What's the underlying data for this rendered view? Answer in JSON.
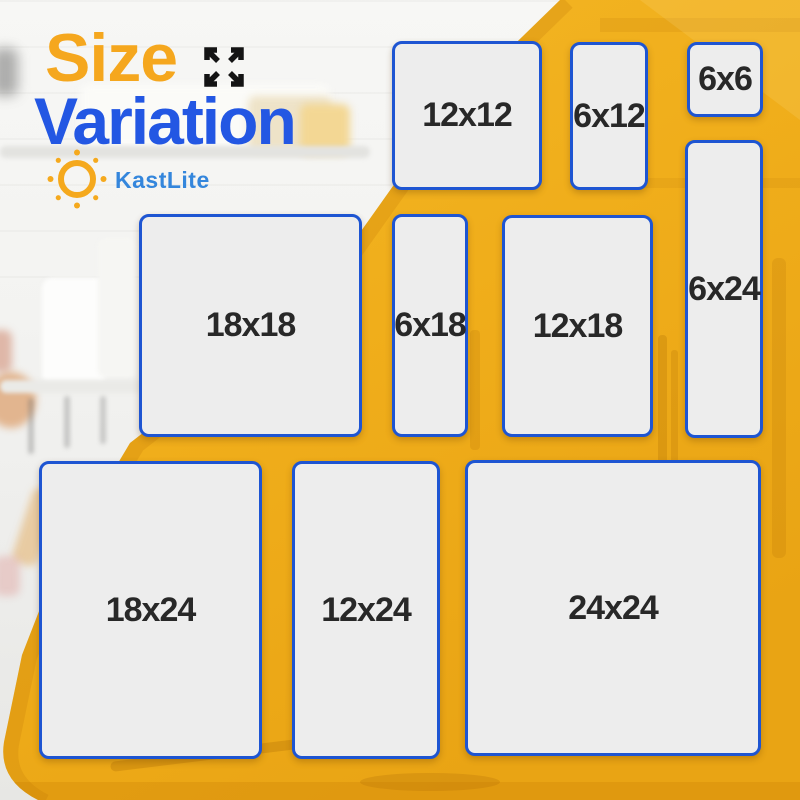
{
  "poster": {
    "title_line1": "Size",
    "title_line2": "Variation",
    "brand": "KastLite"
  },
  "icons": {
    "expand": "expand-arrows-icon",
    "sun": "sun-icon"
  },
  "colors": {
    "title_orange": "#F5A71E",
    "title_blue": "#2357E3",
    "brand_blue": "#3486DC",
    "box_border_blue": "#1E55D2",
    "box_fill": "#EDEDED",
    "label_text": "#282828",
    "background_yellow": "#F0B01E",
    "arrow_icon_black": "#141414"
  },
  "sizes": [
    {
      "label": "12x12",
      "width_in": 12,
      "height_in": 12
    },
    {
      "label": "6x12",
      "width_in": 6,
      "height_in": 12
    },
    {
      "label": "6x6",
      "width_in": 6,
      "height_in": 6
    },
    {
      "label": "6x24",
      "width_in": 6,
      "height_in": 24
    },
    {
      "label": "18x18",
      "width_in": 18,
      "height_in": 18
    },
    {
      "label": "6x18",
      "width_in": 6,
      "height_in": 18
    },
    {
      "label": "12x18",
      "width_in": 12,
      "height_in": 18
    },
    {
      "label": "18x24",
      "width_in": 18,
      "height_in": 24
    },
    {
      "label": "12x24",
      "width_in": 12,
      "height_in": 24
    },
    {
      "label": "24x24",
      "width_in": 24,
      "height_in": 24
    }
  ]
}
